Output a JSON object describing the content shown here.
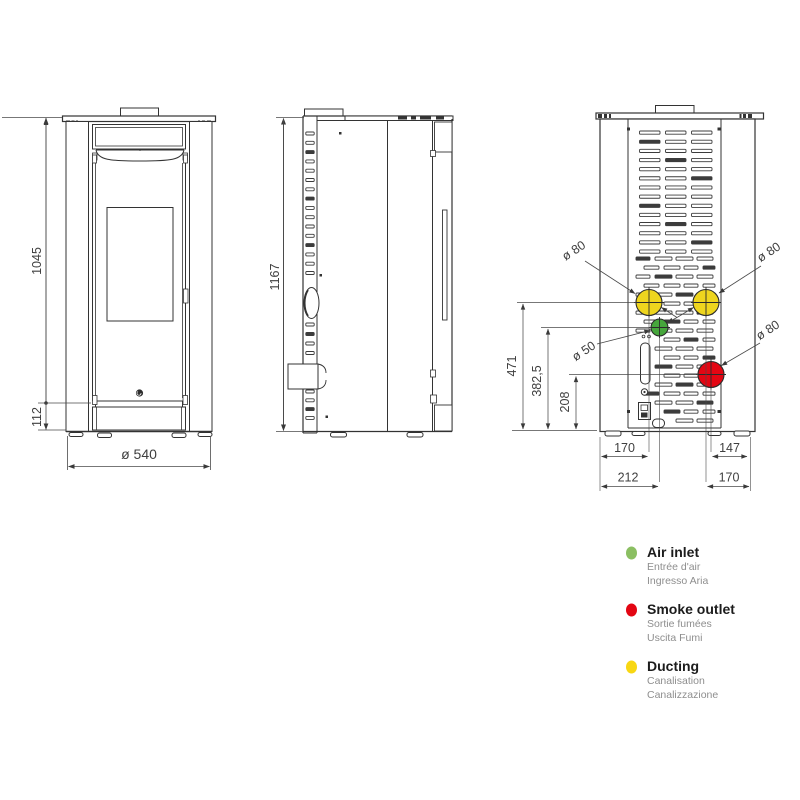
{
  "drawing": {
    "front_view": {
      "overall_height": "1045",
      "plinth_height": "112",
      "body_diameter": "ø 540"
    },
    "side_view": {
      "overall_height": "1167"
    },
    "back_view": {
      "ducting_center_height": "471",
      "air_inlet_center_height": "382,5",
      "smoke_outlet_center_height": "208",
      "ducting_left_offset": "170",
      "air_inlet_left_offset": "212",
      "smoke_outlet_right_offset": "147",
      "ducting_right_offset": "170",
      "ducting_left_diameter": "ø 80",
      "ducting_right_diameter": "ø 80",
      "smoke_outlet_diameter": "ø 80",
      "air_inlet_diameter": "ø 50"
    },
    "colors": {
      "air_inlet": "#46a63c",
      "smoke_outlet": "#e30613",
      "ducting": "#eed51e"
    }
  },
  "legend": {
    "items": [
      {
        "id": "air-inlet",
        "color": "#8bbf62",
        "title": "Air inlet",
        "subtitle_fr": "Entrée d'air",
        "subtitle_it": "Ingresso Aria"
      },
      {
        "id": "smoke-outlet",
        "color": "#e30613",
        "title": "Smoke outlet",
        "subtitle_fr": "Sortie fumées",
        "subtitle_it": "Uscita Fumi"
      },
      {
        "id": "ducting",
        "color": "#f8d713",
        "title": "Ducting",
        "subtitle_fr": "Canalisation",
        "subtitle_it": "Canalizzazione"
      }
    ]
  }
}
